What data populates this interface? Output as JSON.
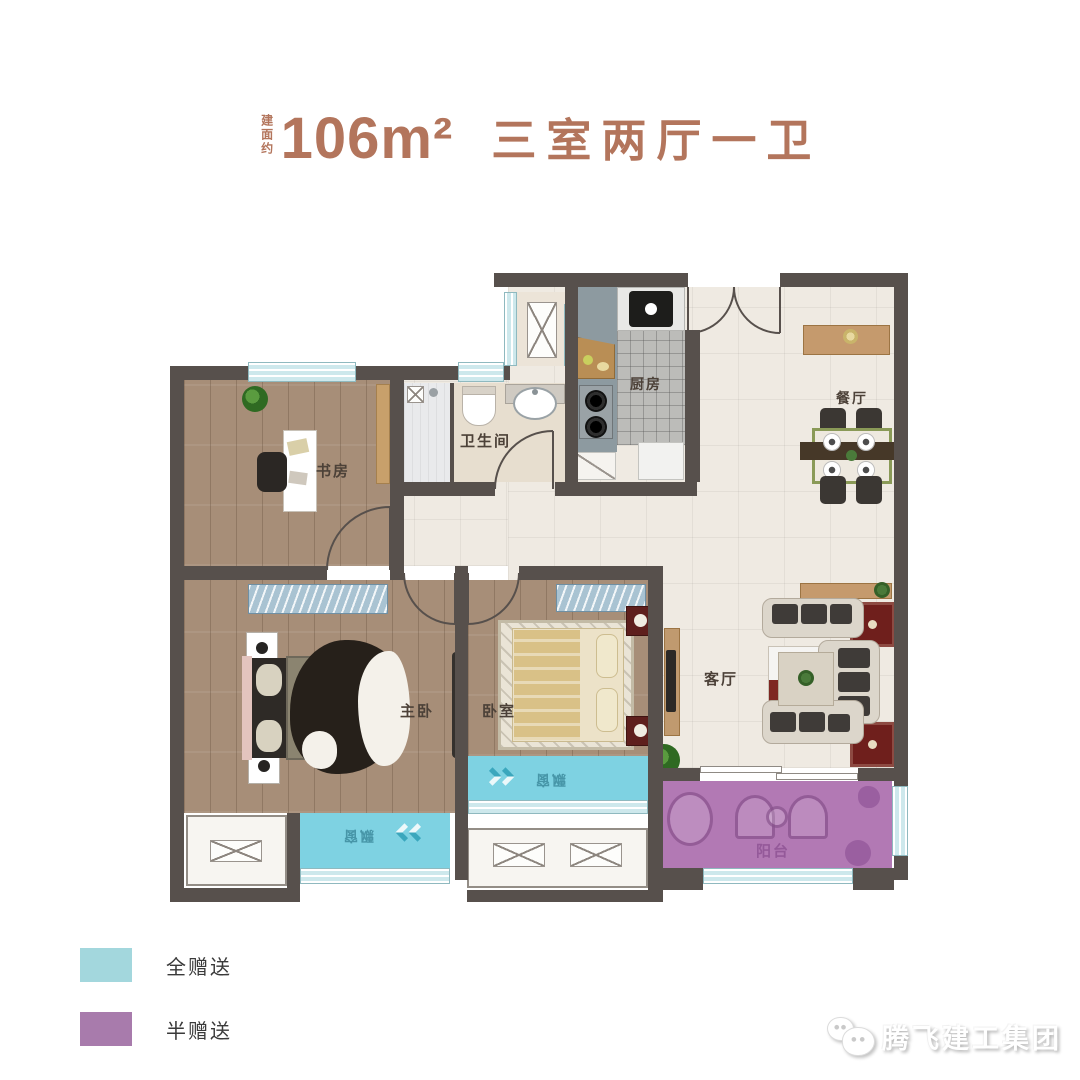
{
  "title": {
    "prefix": "建面约",
    "area": "106m²",
    "layout": "三室两厅一卫"
  },
  "rooms": {
    "study": "书房",
    "bathroom": "卫生间",
    "kitchen": "厨房",
    "dining": "餐厅",
    "master_bedroom": "主卧",
    "bedroom": "卧室",
    "living_room": "客厅",
    "balcony": "阳台",
    "bay_window": "飘窗"
  },
  "legend": {
    "items": [
      {
        "label": "全赠送",
        "color": "#a3d7dd"
      },
      {
        "label": "半赠送",
        "color": "#a87bac"
      }
    ]
  },
  "brand": {
    "name": "腾飞建工集团",
    "icon": "wechat-bubbles-icon"
  },
  "colors": {
    "title_text": "#b3755c",
    "wall": "#57504c",
    "wood_floor": "#a78e78",
    "tile_floor": "#efeae2",
    "kitchen_floor": "#bcbcb9",
    "counter": "#8d9aa0",
    "bay_window": "#7ed2e2",
    "balcony": "#b279b4",
    "window_glass": "#cde8ec",
    "wardrobe": "#a9c3d2"
  }
}
